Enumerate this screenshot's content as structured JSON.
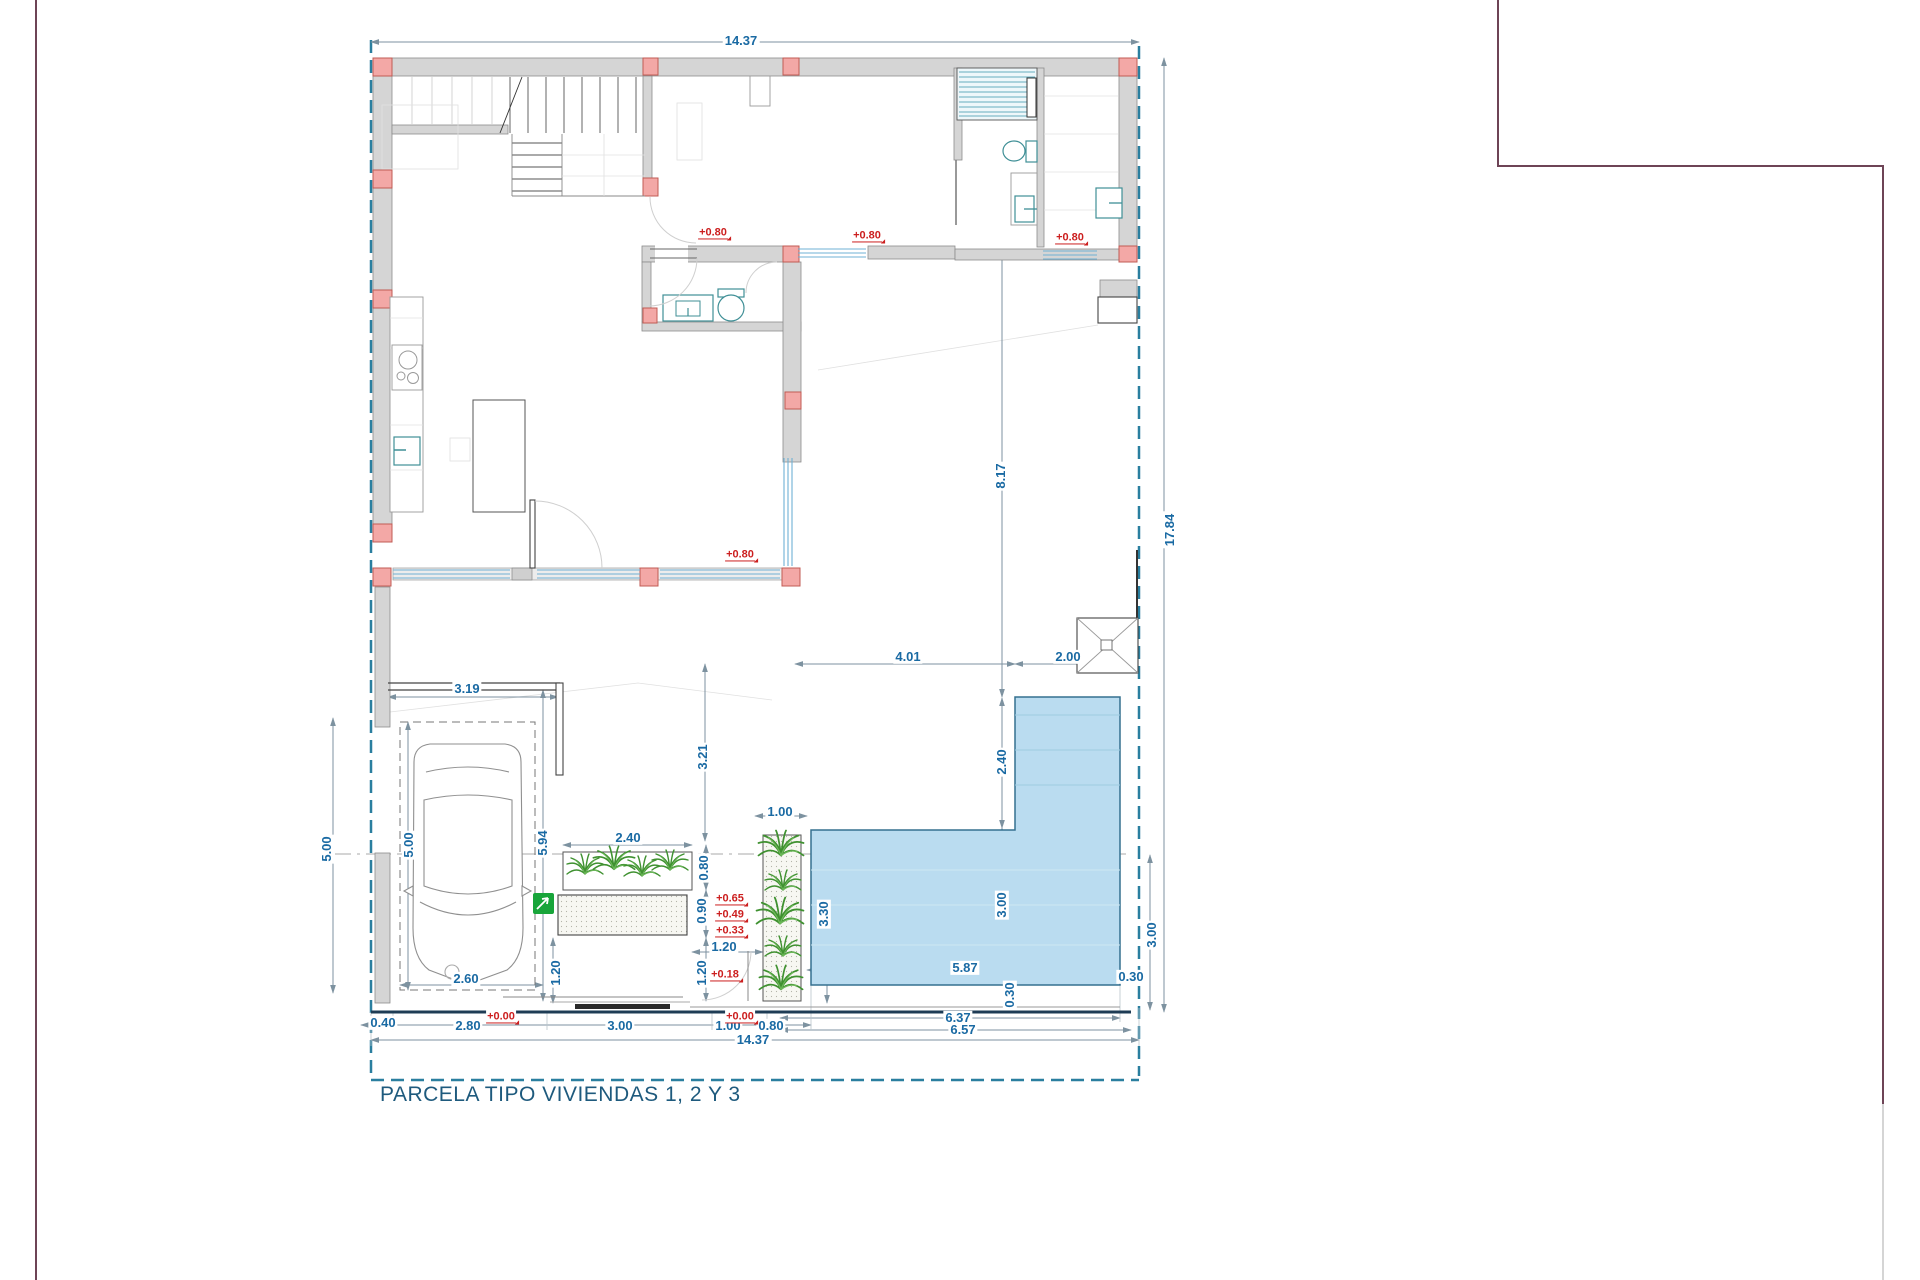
{
  "title": "PARCELA TIPO VIVIENDAS 1, 2 Y 3",
  "colors": {
    "dim_text": "#1a6aa3",
    "level_text": "#cc1f1f",
    "title_color": "#1e5a7d",
    "wall_fill": "#d5d5d5",
    "column_fill": "#f3a8a6",
    "pool_fill": "#badcf0",
    "boundary": "#2a7f9f",
    "parcel_frame": "#6e4456",
    "plant": "#3f9130",
    "sign_green": "#18a53a",
    "street": "#1e3c55"
  },
  "dimensions": [
    {
      "text": "14.37",
      "x": 741,
      "y": 41,
      "rot": 0
    },
    {
      "text": "17.84",
      "x": 1170,
      "y": 530,
      "rot": -90
    },
    {
      "text": "8.17",
      "x": 1001,
      "y": 476,
      "rot": -90
    },
    {
      "text": "4.01",
      "x": 908,
      "y": 657,
      "rot": 0
    },
    {
      "text": "2.00",
      "x": 1068,
      "y": 657,
      "rot": 0
    },
    {
      "text": "2.40",
      "x": 1002,
      "y": 762,
      "rot": -90
    },
    {
      "text": "3.19",
      "x": 467,
      "y": 689,
      "rot": 0
    },
    {
      "text": "3.21",
      "x": 703,
      "y": 757,
      "rot": -90
    },
    {
      "text": "5.00",
      "x": 327,
      "y": 849,
      "rot": -90
    },
    {
      "text": "5.00",
      "x": 409,
      "y": 845,
      "rot": -90
    },
    {
      "text": "5.94",
      "x": 543,
      "y": 843,
      "rot": -90
    },
    {
      "text": "2.40",
      "x": 628,
      "y": 838,
      "rot": 0
    },
    {
      "text": "0.80",
      "x": 704,
      "y": 868,
      "rot": -90
    },
    {
      "text": "0.90",
      "x": 702,
      "y": 911,
      "rot": -90
    },
    {
      "text": "1.20",
      "x": 724,
      "y": 947,
      "rot": 0
    },
    {
      "text": "1.20",
      "x": 702,
      "y": 973,
      "rot": -90
    },
    {
      "text": "1.20",
      "x": 556,
      "y": 973,
      "rot": -90
    },
    {
      "text": "1.00",
      "x": 780,
      "y": 812,
      "rot": 0
    },
    {
      "text": "2.60",
      "x": 466,
      "y": 979,
      "rot": 0
    },
    {
      "text": "3.30",
      "x": 824,
      "y": 914,
      "rot": -90
    },
    {
      "text": "3.00",
      "x": 1002,
      "y": 905,
      "rot": -90
    },
    {
      "text": "3.00",
      "x": 1152,
      "y": 935,
      "rot": -90
    },
    {
      "text": "5.87",
      "x": 965,
      "y": 968,
      "rot": 0
    },
    {
      "text": "0.30",
      "x": 1131,
      "y": 977,
      "rot": 0
    },
    {
      "text": "0.30",
      "x": 1010,
      "y": 995,
      "rot": -90
    },
    {
      "text": "6.37",
      "x": 958,
      "y": 1018,
      "rot": 0
    },
    {
      "text": "6.57",
      "x": 963,
      "y": 1030,
      "rot": 0
    },
    {
      "text": "0.40",
      "x": 383,
      "y": 1023,
      "rot": 0
    },
    {
      "text": "2.80",
      "x": 468,
      "y": 1026,
      "rot": 0
    },
    {
      "text": "3.00",
      "x": 620,
      "y": 1026,
      "rot": 0
    },
    {
      "text": "1.00",
      "x": 728,
      "y": 1026,
      "rot": 0
    },
    {
      "text": "0.80",
      "x": 771,
      "y": 1026,
      "rot": 0
    },
    {
      "text": "14.37",
      "x": 753,
      "y": 1040,
      "rot": 0
    }
  ],
  "levels": [
    {
      "text": "+0.80",
      "x": 713,
      "y": 233
    },
    {
      "text": "+0.80",
      "x": 867,
      "y": 236
    },
    {
      "text": "+0.80",
      "x": 1070,
      "y": 238
    },
    {
      "text": "+0.80",
      "x": 740,
      "y": 555
    },
    {
      "text": "+0.65",
      "x": 730,
      "y": 899
    },
    {
      "text": "+0.49",
      "x": 730,
      "y": 915
    },
    {
      "text": "+0.33",
      "x": 730,
      "y": 931
    },
    {
      "text": "+0.18",
      "x": 725,
      "y": 975
    },
    {
      "text": "+0.00",
      "x": 501,
      "y": 1017
    },
    {
      "text": "+0.00",
      "x": 740,
      "y": 1017
    }
  ]
}
